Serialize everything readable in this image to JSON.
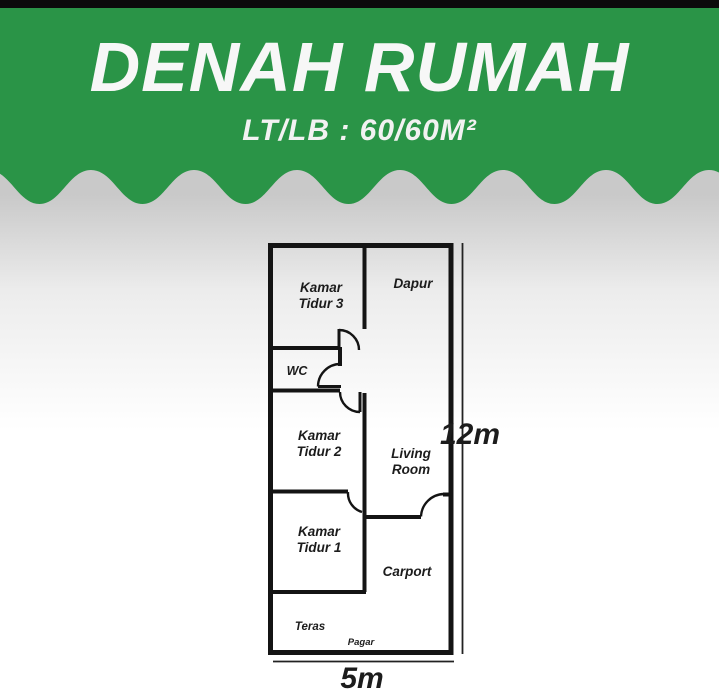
{
  "banner": {
    "title": "DENAH RUMAH",
    "subtitle": "LT/LB : 60/60M²",
    "background_color": "#2a9447",
    "text_color": "#f7f7f7"
  },
  "plan": {
    "wall_color": "#141414",
    "rooms": {
      "kamar_tidur_3": {
        "line1": "Kamar",
        "line2": "Tidur 3"
      },
      "dapur": {
        "line1": "Dapur"
      },
      "wc": {
        "line1": "WC"
      },
      "kamar_tidur_2": {
        "line1": "Kamar",
        "line2": "Tidur 2"
      },
      "living_room": {
        "line1": "Living",
        "line2": "Room"
      },
      "kamar_tidur_1": {
        "line1": "Kamar",
        "line2": "Tidur 1"
      },
      "carport": {
        "line1": "Carport"
      },
      "teras": {
        "line1": "Teras"
      },
      "pagar": {
        "line1": "Pagar"
      }
    },
    "dimensions": {
      "vertical": "12m",
      "horizontal": "5m"
    }
  }
}
